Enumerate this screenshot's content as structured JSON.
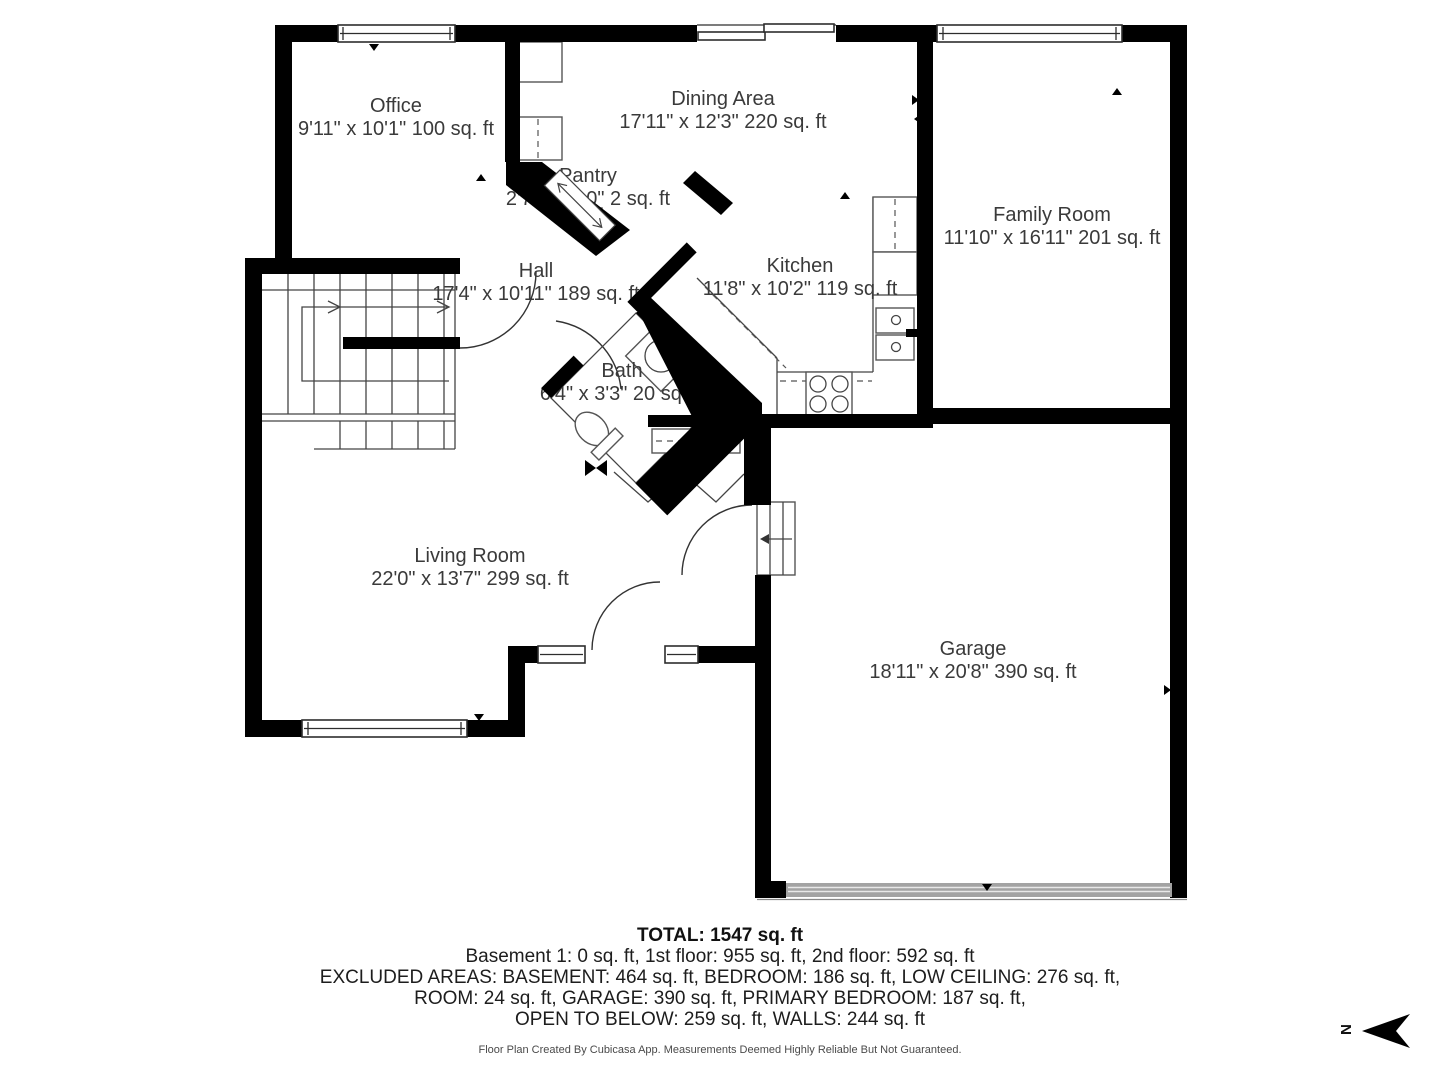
{
  "plan": {
    "rooms": [
      {
        "id": "office",
        "name": "Office",
        "dims": "9'11\" x 10'1\" 100 sq. ft"
      },
      {
        "id": "dining-area",
        "name": "Dining Area",
        "dims": "17'11\" x 12'3\" 220 sq. ft"
      },
      {
        "id": "pantry",
        "name": "Pantry",
        "dims": "2'7\" x 0'10\" 2 sq. ft"
      },
      {
        "id": "family-room",
        "name": "Family Room",
        "dims": "11'10\" x 16'11\" 201 sq. ft"
      },
      {
        "id": "hall",
        "name": "Hall",
        "dims": "17'4\" x 10'11\" 189 sq. ft"
      },
      {
        "id": "kitchen",
        "name": "Kitchen",
        "dims": "11'8\" x 10'2\" 119 sq. ft"
      },
      {
        "id": "bath",
        "name": "Bath",
        "dims": "6'4\" x 3'3\" 20 sq. ft"
      },
      {
        "id": "living-room",
        "name": "Living Room",
        "dims": "22'0\" x 13'7\" 299 sq. ft"
      },
      {
        "id": "garage",
        "name": "Garage",
        "dims": "18'11\" x 20'8\" 390 sq. ft"
      }
    ]
  },
  "summary": {
    "total": "TOTAL: 1547 sq. ft",
    "line1": "Basement 1: 0 sq. ft, 1st floor: 955 sq. ft, 2nd floor: 592 sq. ft",
    "line2": "EXCLUDED AREAS: BASEMENT: 464 sq. ft, BEDROOM: 186 sq. ft, LOW CEILING: 276 sq. ft,",
    "line3": "ROOM: 24 sq. ft, GARAGE: 390 sq. ft, PRIMARY BEDROOM: 187 sq. ft,",
    "line4": "OPEN TO BELOW: 259 sq. ft, WALLS: 244 sq. ft"
  },
  "disclaimer": "Floor Plan Created By Cubicasa App. Measurements Deemed Highly Reliable But Not Guaranteed.",
  "compass": {
    "label": "N"
  },
  "colors": {
    "wall": "#000000",
    "garage_door": "#a3a3a3",
    "label_text": "#3a3a3a"
  }
}
